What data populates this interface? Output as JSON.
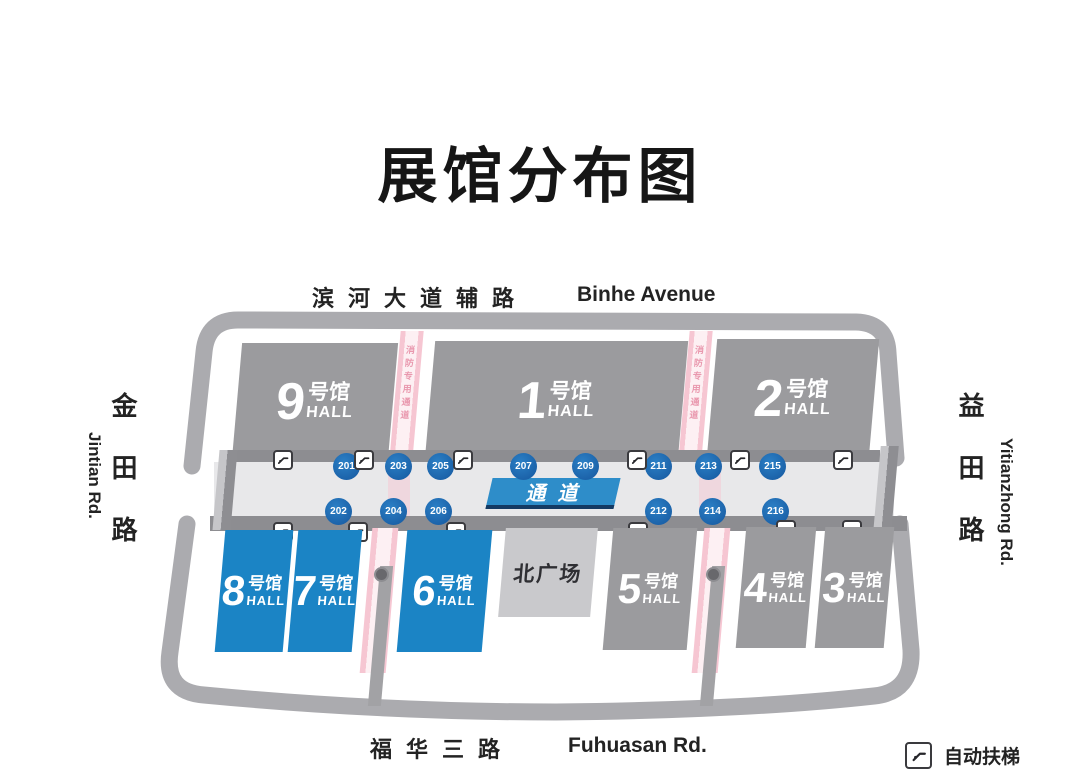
{
  "title": "展馆分布图",
  "roads": {
    "top_zh": "滨河大道辅路",
    "top_en": "Binhe Avenue",
    "left_zh": "金田路",
    "left_en": "Jintian Rd.",
    "right_zh": "益田路",
    "right_en": "Yitianzhong Rd.",
    "bottom_zh": "福华三路",
    "bottom_en": "Fuhuasan Rd."
  },
  "halls": {
    "h9": {
      "number": "9",
      "suffix": "号馆",
      "word": "HALL"
    },
    "h1": {
      "number": "1",
      "suffix": "号馆",
      "word": "HALL"
    },
    "h2": {
      "number": "2",
      "suffix": "号馆",
      "word": "HALL"
    },
    "h8": {
      "number": "8",
      "suffix": "号馆",
      "word": "HALL"
    },
    "h7": {
      "number": "7",
      "suffix": "号馆",
      "word": "HALL"
    },
    "h6": {
      "number": "6",
      "suffix": "号馆",
      "word": "HALL"
    },
    "h5": {
      "number": "5",
      "suffix": "号馆",
      "word": "HALL"
    },
    "h4": {
      "number": "4",
      "suffix": "号馆",
      "word": "HALL"
    },
    "h3": {
      "number": "3",
      "suffix": "号馆",
      "word": "HALL"
    }
  },
  "plaza_label": "北广场",
  "corridor_sign": "通道",
  "fire_lane_label": "消防专用通道",
  "gates": {
    "top": [
      "201",
      "203",
      "205",
      "207",
      "209",
      "211",
      "213",
      "215"
    ],
    "bottom": [
      "202",
      "204",
      "206",
      "212",
      "214",
      "216"
    ]
  },
  "legend": {
    "escalator_label": "自动扶梯"
  },
  "colors": {
    "hall_gray": "#9b9b9e",
    "hall_blue": "#1b84c5",
    "gate_blue": "#1d6cb5",
    "fire_pink": "#f6c6d2",
    "corridor_gray": "#e8e8ea",
    "wall_gray": "#ababaf",
    "sign_blue": "#2e8dc9"
  }
}
